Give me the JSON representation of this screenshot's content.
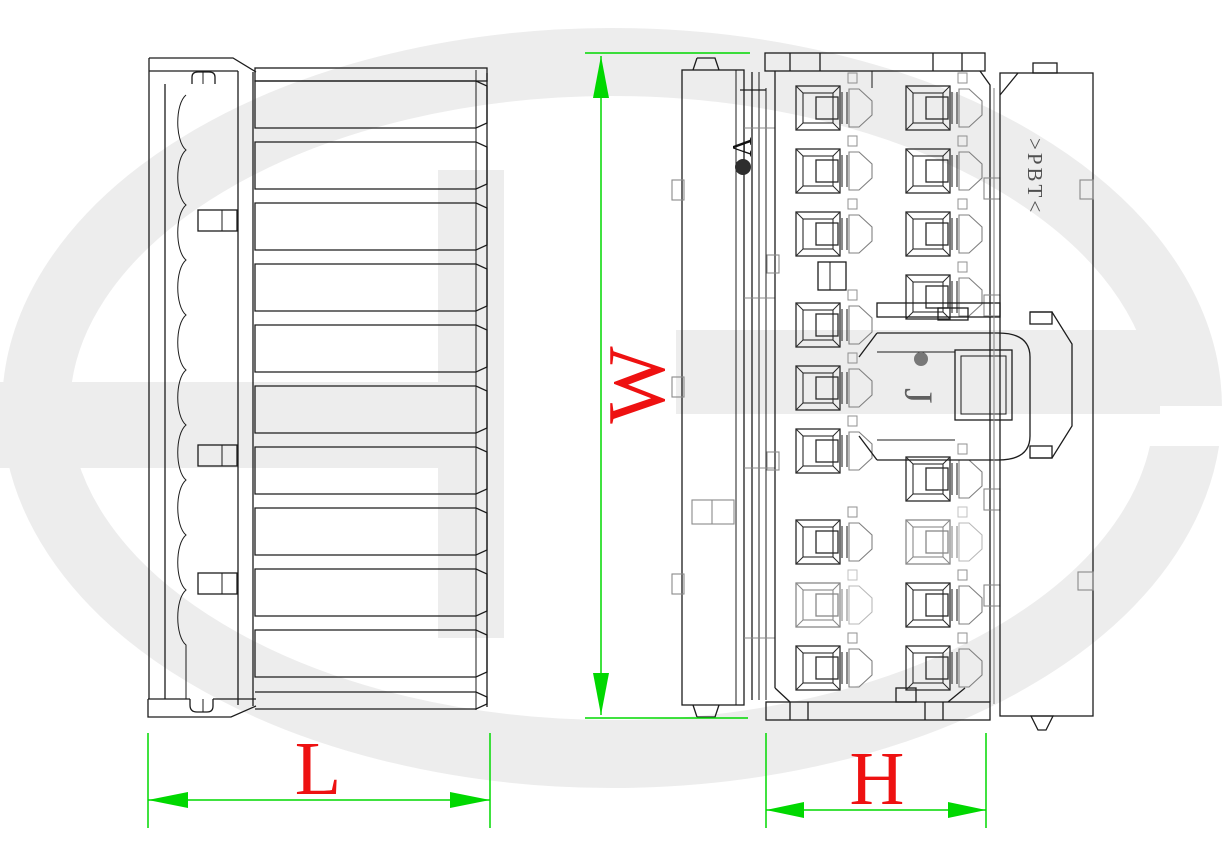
{
  "drawing": {
    "type": "connector-engineering-drawing",
    "views": [
      {
        "id": "side-view",
        "position": "left"
      },
      {
        "id": "front-view",
        "position": "right"
      }
    ],
    "dimensions": [
      {
        "id": "L",
        "label": "L",
        "orientation": "horizontal",
        "view": "side-view"
      },
      {
        "id": "W",
        "label": "W",
        "orientation": "vertical",
        "view": "front-view"
      },
      {
        "id": "H",
        "label": "H",
        "orientation": "horizontal",
        "view": "front-view"
      }
    ],
    "annotations": [
      {
        "id": "A",
        "label": "A",
        "meaning": "datum-point"
      },
      {
        "id": "J",
        "label": "J",
        "meaning": "latch-point"
      },
      {
        "id": "PBT",
        "label": ">PBT<",
        "meaning": "material-marking"
      }
    ]
  },
  "colors": {
    "dimension_green": "#00d800",
    "label_red": "#ee1111",
    "line_dark": "#1c1c1c",
    "line_gray": "#8a8a8a",
    "watermark_gray": "#ededed"
  }
}
